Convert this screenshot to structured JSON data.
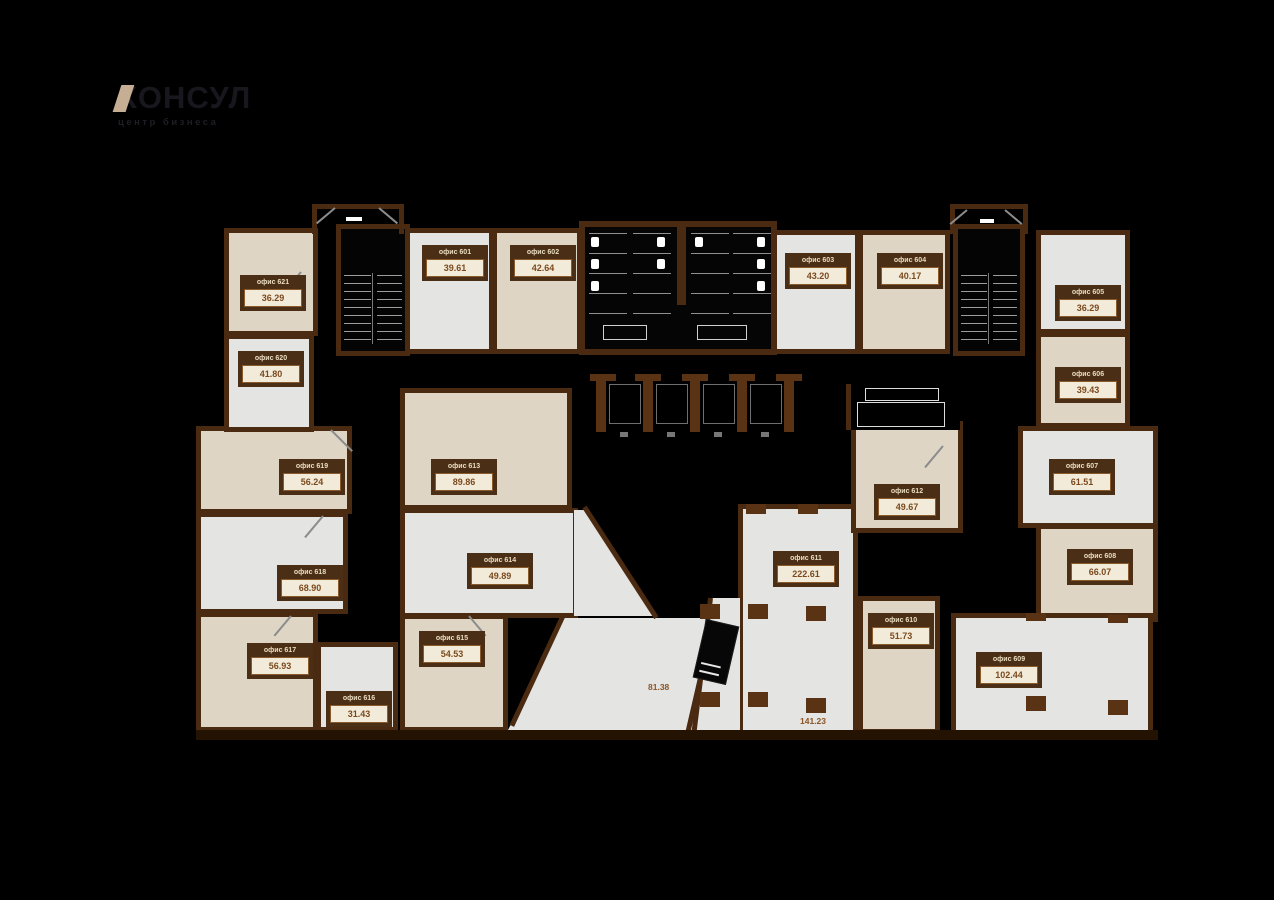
{
  "logo": {
    "title": "КОНСУЛ",
    "subtitle": "центр бизнеса"
  },
  "floor_plan": {
    "rooms": [
      {
        "name": "офис 601",
        "area": "39.61"
      },
      {
        "name": "офис 602",
        "area": "42.64"
      },
      {
        "name": "офис 603",
        "area": "43.20"
      },
      {
        "name": "офис 604",
        "area": "40.17"
      },
      {
        "name": "офис 605",
        "area": "36.29"
      },
      {
        "name": "офис 606",
        "area": "39.43"
      },
      {
        "name": "офис 607",
        "area": "61.51"
      },
      {
        "name": "офис 608",
        "area": "66.07"
      },
      {
        "name": "офис 609",
        "area": "102.44"
      },
      {
        "name": "офис 610",
        "area": "51.73"
      },
      {
        "name": "офис 611",
        "area": "222.61"
      },
      {
        "name": "офис 612",
        "area": "49.67"
      },
      {
        "name": "офис 613",
        "area": "89.86"
      },
      {
        "name": "офис 614",
        "area": "49.89"
      },
      {
        "name": "офис 615",
        "area": "54.53"
      },
      {
        "name": "офис 616",
        "area": "31.43"
      },
      {
        "name": "офис 617",
        "area": "56.93"
      },
      {
        "name": "офис 618",
        "area": "68.90"
      },
      {
        "name": "офис 619",
        "area": "56.24"
      },
      {
        "name": "офис 620",
        "area": "41.80"
      },
      {
        "name": "офис 621",
        "area": "36.29"
      }
    ],
    "common_areas": [
      {
        "area": "81.38"
      },
      {
        "area": "141.23"
      }
    ]
  },
  "colors": {
    "background": "#000000",
    "wall": "#4a2a10",
    "wall_light": "#6e3c14",
    "room_white": "#e4e4e2",
    "room_beige": "#ded5c5",
    "label_header_bg": "#4a2e16",
    "label_header_text": "#eadcc1",
    "label_body_bg": "#f3ebda",
    "label_value_text": "#7a4a1e",
    "logo_accent": "#c5ae94"
  }
}
